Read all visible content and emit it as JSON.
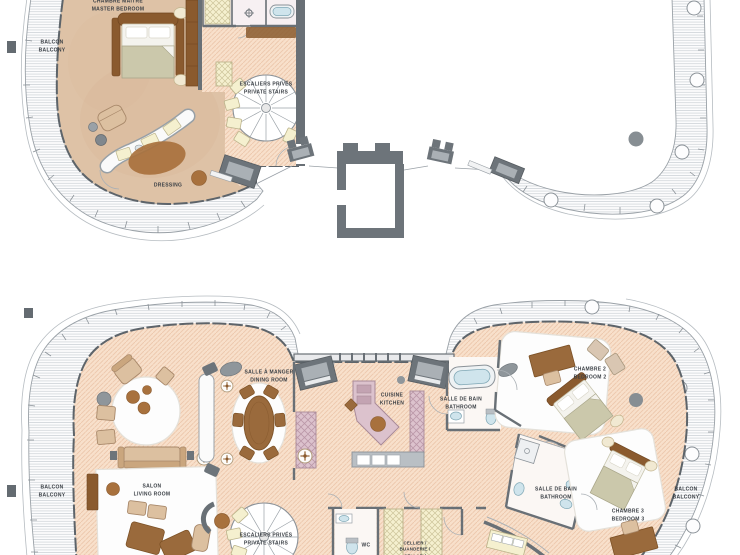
{
  "title": "Penthouse two-level floor plan",
  "labels": {
    "master_bedroom": "CHAMBRE MAITRE\nMASTER BEDROOM",
    "balcony_upper": "BALCON\nBALCONY",
    "private_stairs_upper": "ESCALIERS PRIVÉS\nPRIVATE STAIRS",
    "dressing": "DRESSING",
    "balcony_lower_left": "BALCON\nBALCONY",
    "living_room": "SALON\nLIVING ROOM",
    "dining_room": "SALLE À MANGER\nDINING ROOM",
    "kitchen": "CUISINE\nKITCHEN",
    "bathroom_main": "SALLE DE BAIN\nBATHROOM",
    "bedroom_2": "CHAMBRE 2\nBEDROOM 2",
    "bathroom_2": "SALLE DE BAIN\nBATHROOM",
    "bedroom_3": "CHAMBRE 3\nBEDROOM 3",
    "balcony_lower_right": "BALCON\nBALCONY",
    "private_stairs_lower": "ESCALIERS PRIVÉS\nPRIVATE STAIRS",
    "wc": "WC",
    "cellar": "CELLIER /\nBUANDERIE /\nCELLAR /"
  },
  "colors": {
    "floor_hatch_peach": "#f8e0cb",
    "floor_tan": "#dec2a6",
    "wall_dark": "#697076",
    "balcony_deck": "#fcfcfd",
    "furniture_brown": "#9a6a3c",
    "furniture_tan": "#dcc0a0",
    "kitchen_mauve": "#dcc2cd",
    "closet_yellow": "#f5f0cf",
    "fixture_blue": "#cfe4ec",
    "bed_sage": "#cbc8ab"
  }
}
